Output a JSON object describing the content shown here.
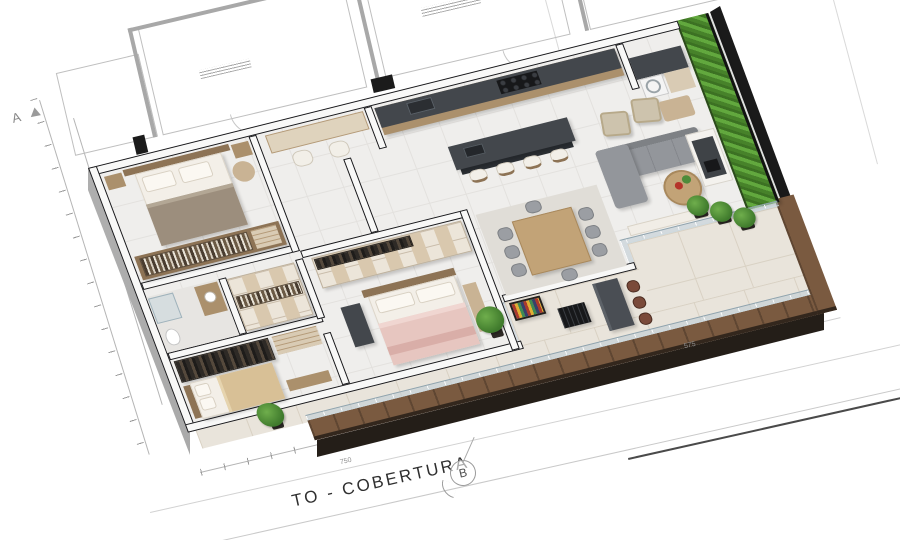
{
  "document": {
    "title_partial": "TO - COBERTURA",
    "markers": {
      "a": "A",
      "b": "B"
    },
    "dimension_labels": {
      "bottom": "750",
      "right": "575"
    }
  },
  "palette": {
    "paper": "#ffffff",
    "plan_line_gray": "#bfbfbf",
    "wall_edge": "#17171a",
    "interior_floor": "#efeeec",
    "terrace_floor": "#e9e4db",
    "deck_wood": "#7a5a40",
    "green_wall": "#559433",
    "counter_dark": "#43474c",
    "cabinet_wood": "#ab906c",
    "sofa_gray": "#93969b",
    "armchair_beige": "#cdc3ad",
    "dining_table_wood": "#c2a377",
    "bed_master_pink": "#e7c6c0",
    "bed_guest_beige": "#d8c096",
    "bed_blanket_taupe": "#9c8e7d",
    "bar_stool_brown": "#7a4a3a",
    "plant_green": "#4e8c3a",
    "glass_railing": "#bbccd3"
  }
}
